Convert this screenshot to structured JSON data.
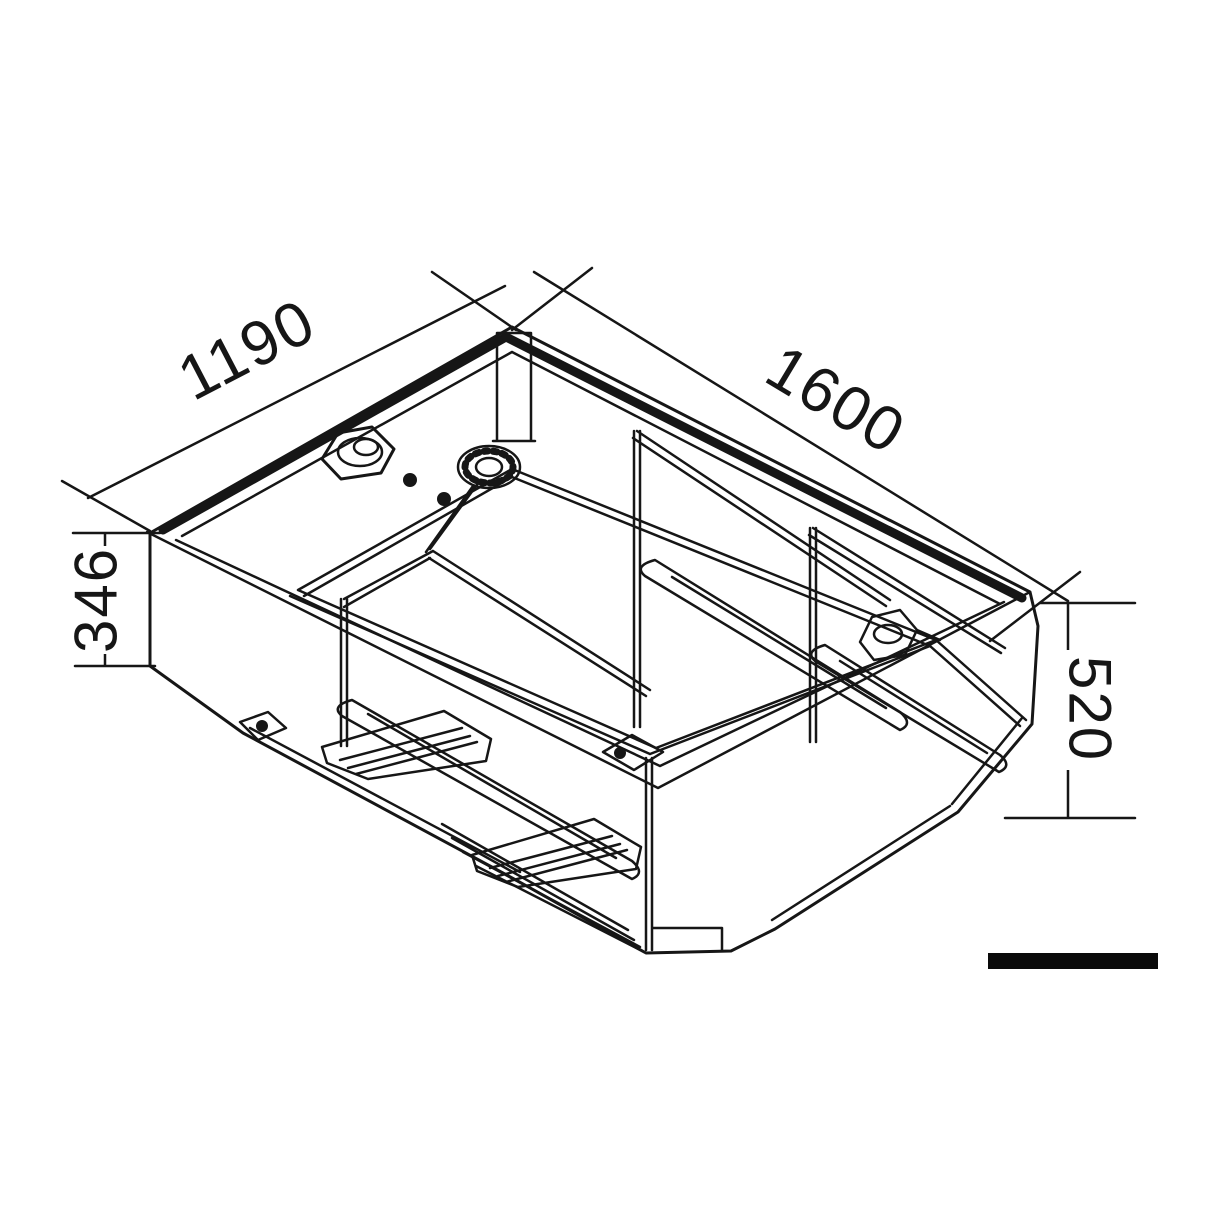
{
  "page": {
    "background": "#ffffff",
    "description": "Isometric technical line drawing of a rectangular tank with internal baffles, filler neck, sender flange and outlet fittings, annotated with four dimensions and a scale bar."
  },
  "drawing": {
    "line_color": "#161616",
    "dimensions": {
      "top_left": {
        "value": "1190"
      },
      "top_right": {
        "value": "1600"
      },
      "left": {
        "value": "346"
      },
      "right": {
        "value": "520"
      }
    },
    "scale_bar": {
      "color": "#0a0a0a"
    }
  }
}
